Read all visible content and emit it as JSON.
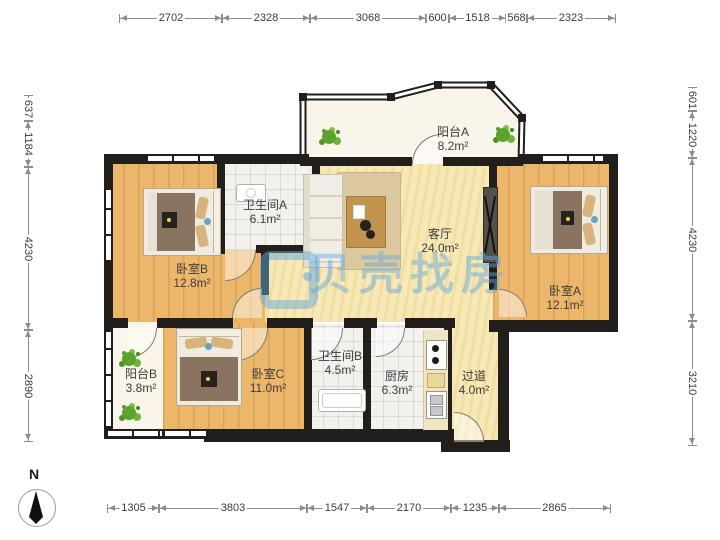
{
  "title": "apartment-floor-plan",
  "watermark": {
    "text": "贝壳找房",
    "color": "#64aadc"
  },
  "compass": {
    "label": "N"
  },
  "colors": {
    "wall": "#211e1b",
    "wood_floor": "#ecb76b",
    "living_floor": "#f7e9b6",
    "tile_floor": "#f3f1ee",
    "balcony_floor": "#f9f5ea",
    "plant_green": "#5da22f",
    "watermark_blue": "#64aadc"
  },
  "rooms": [
    {
      "name": "阳台A",
      "area": "8.2m²"
    },
    {
      "name": "卫生间A",
      "area": "6.1m²"
    },
    {
      "name": "卧室B",
      "area": "12.8m²"
    },
    {
      "name": "客厅",
      "area": "24.0m²"
    },
    {
      "name": "卧室A",
      "area": "12.1m²"
    },
    {
      "name": "阳台B",
      "area": "3.8m²"
    },
    {
      "name": "卧室C",
      "area": "11.0m²"
    },
    {
      "name": "卫生间B",
      "area": "4.5m²"
    },
    {
      "name": "厨房",
      "area": "6.3m²"
    },
    {
      "name": "过道",
      "area": "4.0m²"
    }
  ],
  "dimensions": {
    "top": [
      "2702",
      "2328",
      "3068",
      "600",
      "1518",
      "568",
      "2323"
    ],
    "bottom": [
      "1305",
      "3803",
      "1547",
      "2170",
      "1235",
      "2865"
    ],
    "left": [
      "637",
      "1184",
      "4230",
      "2890"
    ],
    "right": [
      "601",
      "1220",
      "4230",
      "3210"
    ]
  }
}
